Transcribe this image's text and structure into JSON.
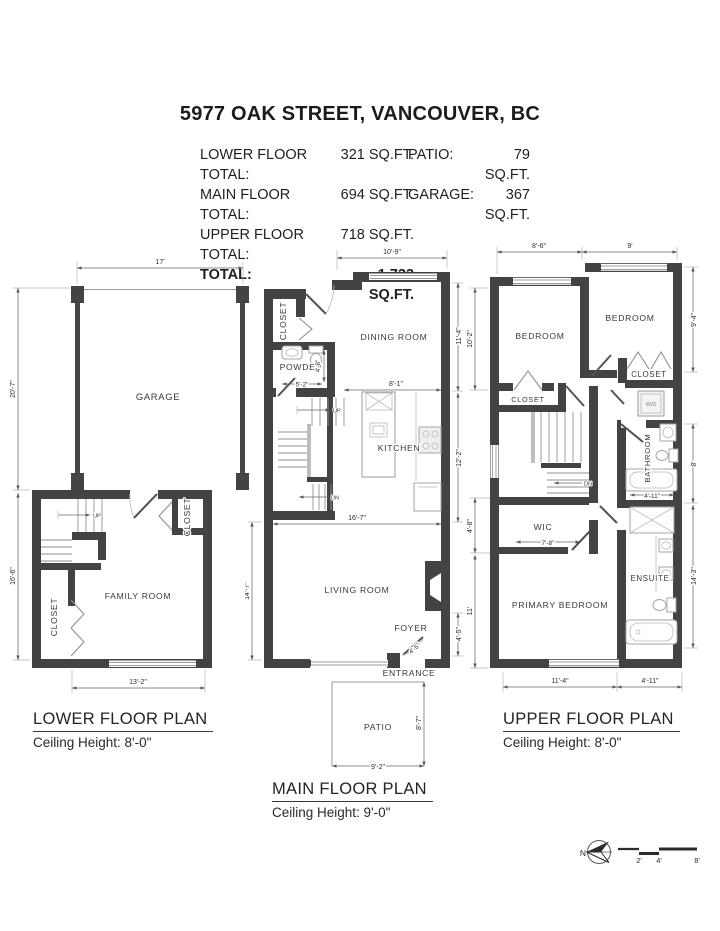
{
  "header": {
    "title": "5977 OAK STREET, VANCOUVER, BC",
    "rows": [
      {
        "l1": "LOWER FLOOR TOTAL:",
        "v1": "321 SQ.FT.",
        "l2": "PATIO:",
        "v2": "79 SQ.FT."
      },
      {
        "l1": "MAIN FLOOR TOTAL:",
        "v1": "694 SQ.FT.",
        "l2": "GARAGE:",
        "v2": "367 SQ.FT."
      },
      {
        "l1": "UPPER FLOOR TOTAL:",
        "v1": "718 SQ.FT.",
        "l2": "",
        "v2": ""
      },
      {
        "l1": "TOTAL:",
        "v1": "1,733 SQ.FT.",
        "l2": "",
        "v2": ""
      }
    ]
  },
  "lower": {
    "title": "LOWER FLOOR PLAN",
    "ceiling": "Ceiling Height: 8'-0\"",
    "rooms": {
      "garage": "GARAGE",
      "family": "FAMILY ROOM",
      "closet_l": "CLOSET",
      "closet_r": "CLOSET"
    },
    "dims": {
      "top": "17'",
      "left_garage": "20'-7\"",
      "left_family": "16'-6\"",
      "bottom": "13'-2\""
    },
    "stair_up": "UP"
  },
  "main": {
    "title": "MAIN FLOOR PLAN",
    "ceiling": "Ceiling Height: 9'-0\"",
    "rooms": {
      "closet": "CLOSET",
      "powder": "POWDER",
      "dining": "DINING ROOM",
      "kitchen": "KITCHEN",
      "living": "LIVING ROOM",
      "foyer": "FOYER",
      "entrance": "ENTRANCE",
      "patio": "PATIO"
    },
    "dims": {
      "top": "10'-9\"",
      "right_dining": "11'-4\"",
      "right_kitchen": "12'-2\"",
      "right_foyer": "4'-5\"",
      "left_living": "14'-7\"",
      "living_w": "16'-7\"",
      "kitchen_w": "8'-1\"",
      "powder_w": "5'-2\"",
      "powder_h": "4'-8\"",
      "foyer_door": "4'-5\"",
      "patio_w": "9'-2\"",
      "patio_h": "8'-7\""
    },
    "stair_up": "UP",
    "stair_dn": "DN"
  },
  "upper": {
    "title": "UPPER FLOOR PLAN",
    "ceiling": "Ceiling Height: 8'-0\"",
    "rooms": {
      "bedroom_l": "BEDROOM",
      "bedroom_r": "BEDROOM",
      "closet_l": "CLOSET",
      "closet_r": "CLOSET",
      "wd": "W/D",
      "bathroom": "BATHROOM",
      "wic": "WIC",
      "primary": "PRIMARY BEDROOM",
      "ensuite": "ENSUITE"
    },
    "dims": {
      "top_l": "8'-6\"",
      "top_r": "9'",
      "right_bed": "9'-4\"",
      "right_bath": "8'",
      "right_ens": "14'-3\"",
      "left_bed": "10'-2\"",
      "left_wic": "4'-8\"",
      "left_primary": "11'",
      "wic_w": "7'-8\"",
      "bath_w": "4'-11\"",
      "bottom_l": "11'-4\"",
      "bottom_r": "4'-11\""
    },
    "stair_dn": "DN"
  },
  "footer": {
    "compass_n": "N",
    "scale": [
      "2'",
      "4'",
      "8'"
    ]
  },
  "colors": {
    "wall": "#434345",
    "line": "#9b9b9d",
    "text": "#2e2e30"
  }
}
